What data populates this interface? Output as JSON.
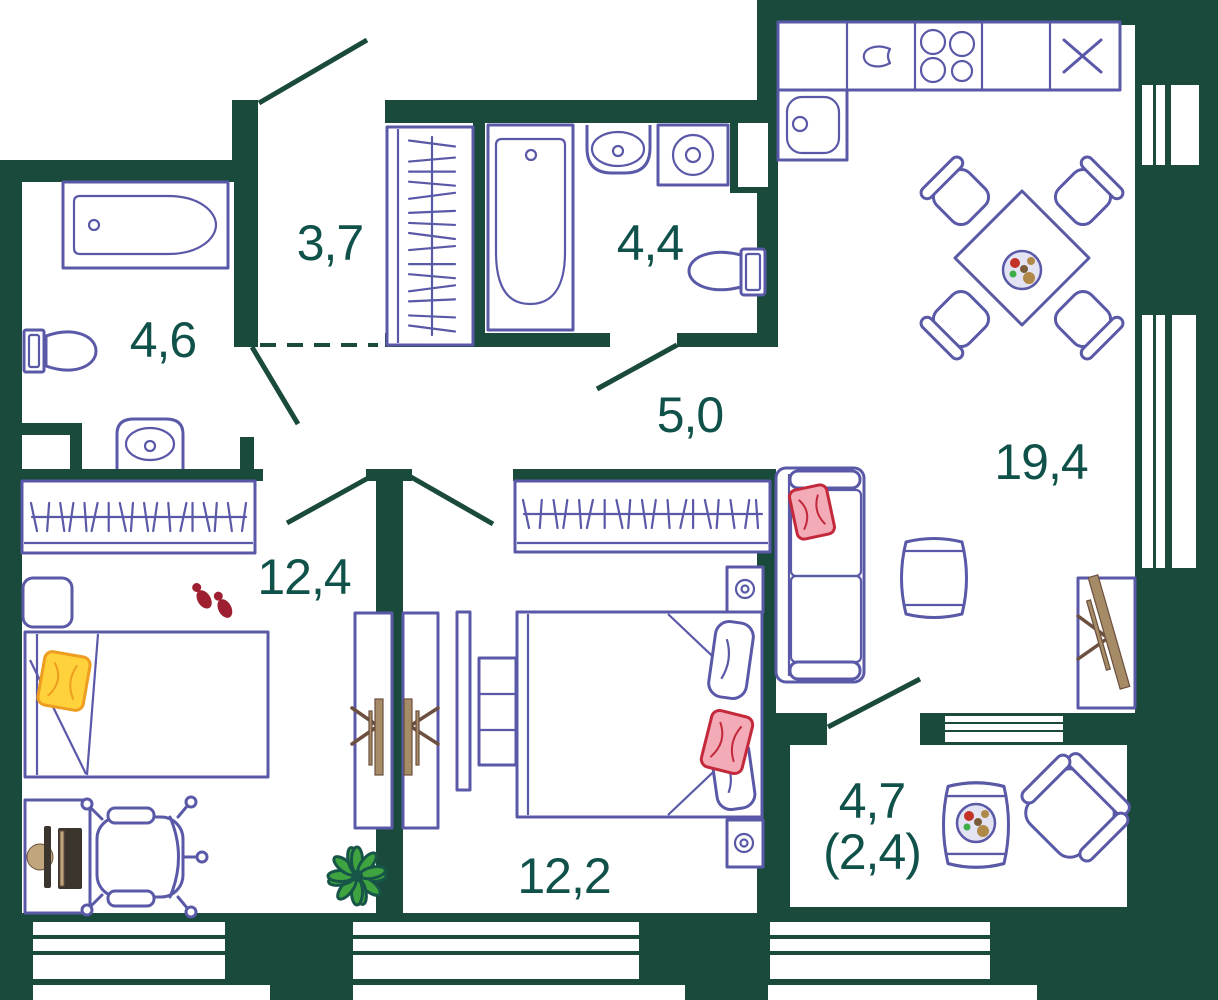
{
  "plan_type": "apartment-floor-plan",
  "rooms": [
    {
      "name": "bathroom-left",
      "area": "4,6"
    },
    {
      "name": "entry-hall",
      "area": "3,7"
    },
    {
      "name": "bathroom-top",
      "area": "4,4"
    },
    {
      "name": "corridor",
      "area": "5,0"
    },
    {
      "name": "kitchen-living",
      "area": "19,4"
    },
    {
      "name": "bedroom-left",
      "area": "12,4"
    },
    {
      "name": "bedroom-right",
      "area": "12,2"
    },
    {
      "name": "balcony",
      "area": "4,7",
      "area_note": "(2,4)"
    }
  ],
  "colors": {
    "wall": "#1a4a3c",
    "furniture": "#5a59a8",
    "label": "#10524a",
    "pink": "#f2abb7",
    "pink_stroke": "#c3293b",
    "red": "#9e2030",
    "yellow": "#ffd23c",
    "yellow_stroke": "#ed9d20",
    "plant": "#3fa33f",
    "plant_dark": "#175549",
    "wood": "#a58b66",
    "wood_dark": "#6b4f3f",
    "plate": "#e3e3f3",
    "tan": "#c0a67c",
    "dark": "#3b352e",
    "food_red": "#c23227",
    "food_green": "#3fae49",
    "food_brown": "#b08948",
    "food_dbrown": "#7a5b3a"
  },
  "furniture_symbols": [
    "bathtub",
    "toilet",
    "washbasin",
    "washing-machine",
    "coat-closet",
    "wardrobe",
    "kitchen-counter",
    "kitchen-sink",
    "cooktop",
    "dining-table",
    "dining-chair",
    "plate-of-food",
    "sofa",
    "pillow",
    "side-table",
    "tv",
    "tv-stand",
    "bed",
    "nightstand",
    "lamp",
    "chest-of-drawers",
    "desk",
    "computer",
    "office-chair",
    "plant",
    "slippers",
    "armchair",
    "door-swing",
    "window"
  ]
}
